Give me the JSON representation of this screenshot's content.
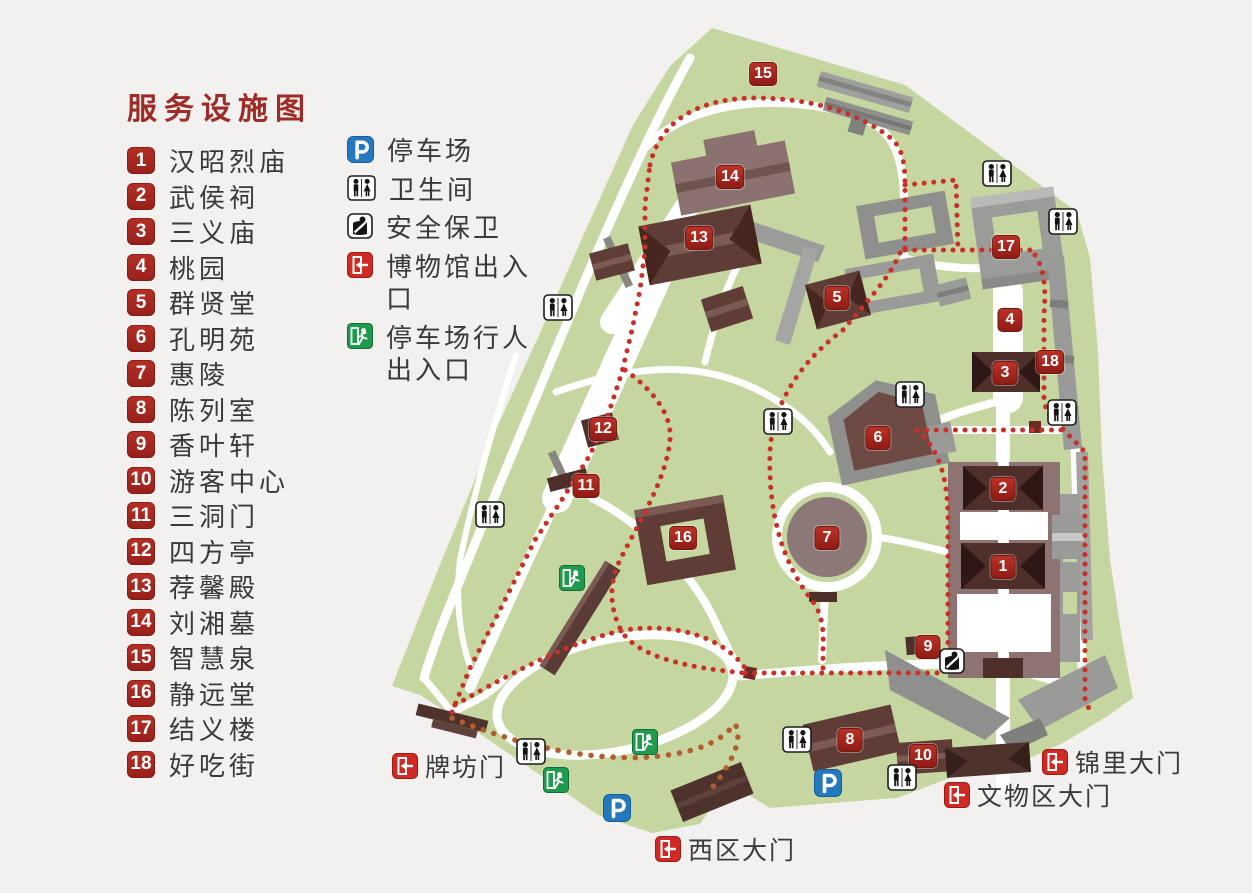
{
  "legend": {
    "title": "服务设施图",
    "items": [
      {
        "number": "1",
        "label": "汉昭烈庙"
      },
      {
        "number": "2",
        "label": "武侯祠"
      },
      {
        "number": "3",
        "label": "三义庙"
      },
      {
        "number": "4",
        "label": "桃园"
      },
      {
        "number": "5",
        "label": "群贤堂"
      },
      {
        "number": "6",
        "label": "孔明苑"
      },
      {
        "number": "7",
        "label": "惠陵"
      },
      {
        "number": "8",
        "label": "陈列室"
      },
      {
        "number": "9",
        "label": "香叶轩"
      },
      {
        "number": "10",
        "label": "游客中心"
      },
      {
        "number": "11",
        "label": "三洞门"
      },
      {
        "number": "12",
        "label": "四方亭"
      },
      {
        "number": "13",
        "label": "荐馨殿"
      },
      {
        "number": "14",
        "label": "刘湘墓"
      },
      {
        "number": "15",
        "label": "智慧泉"
      },
      {
        "number": "16",
        "label": "静远堂"
      },
      {
        "number": "17",
        "label": "结义楼"
      },
      {
        "number": "18",
        "label": "好吃街"
      }
    ]
  },
  "facilities": {
    "items": [
      {
        "icon": "parking-icon",
        "label": "停车场"
      },
      {
        "icon": "toilet-icon",
        "label": "卫生间"
      },
      {
        "icon": "security-icon",
        "label": "安全保卫"
      },
      {
        "icon": "museum-exit-icon",
        "label": "博物馆出入口"
      },
      {
        "icon": "pedestrian-exit-icon",
        "label": "停车场行人出入口"
      }
    ]
  },
  "map": {
    "markers": [
      {
        "number": "1"
      },
      {
        "number": "2"
      },
      {
        "number": "3"
      },
      {
        "number": "4"
      },
      {
        "number": "5"
      },
      {
        "number": "6"
      },
      {
        "number": "7"
      },
      {
        "number": "8"
      },
      {
        "number": "9"
      },
      {
        "number": "10"
      },
      {
        "number": "11"
      },
      {
        "number": "12"
      },
      {
        "number": "13"
      },
      {
        "number": "14"
      },
      {
        "number": "15"
      },
      {
        "number": "16"
      },
      {
        "number": "17"
      },
      {
        "number": "18"
      }
    ],
    "gates": [
      {
        "label": "牌坊门"
      },
      {
        "label": "西区大门"
      },
      {
        "label": "文物区大门"
      },
      {
        "label": "锦里大门"
      }
    ]
  },
  "colors": {
    "title_red": "#9e2b26",
    "marker_red": "#a8241c",
    "route_red": "#c93028",
    "route_orange": "#b35c2e",
    "lawn_green": "#c5d6a0",
    "parking_blue": "#2577be",
    "exit_red": "#cf2b24",
    "exit_green": "#209a4e"
  }
}
